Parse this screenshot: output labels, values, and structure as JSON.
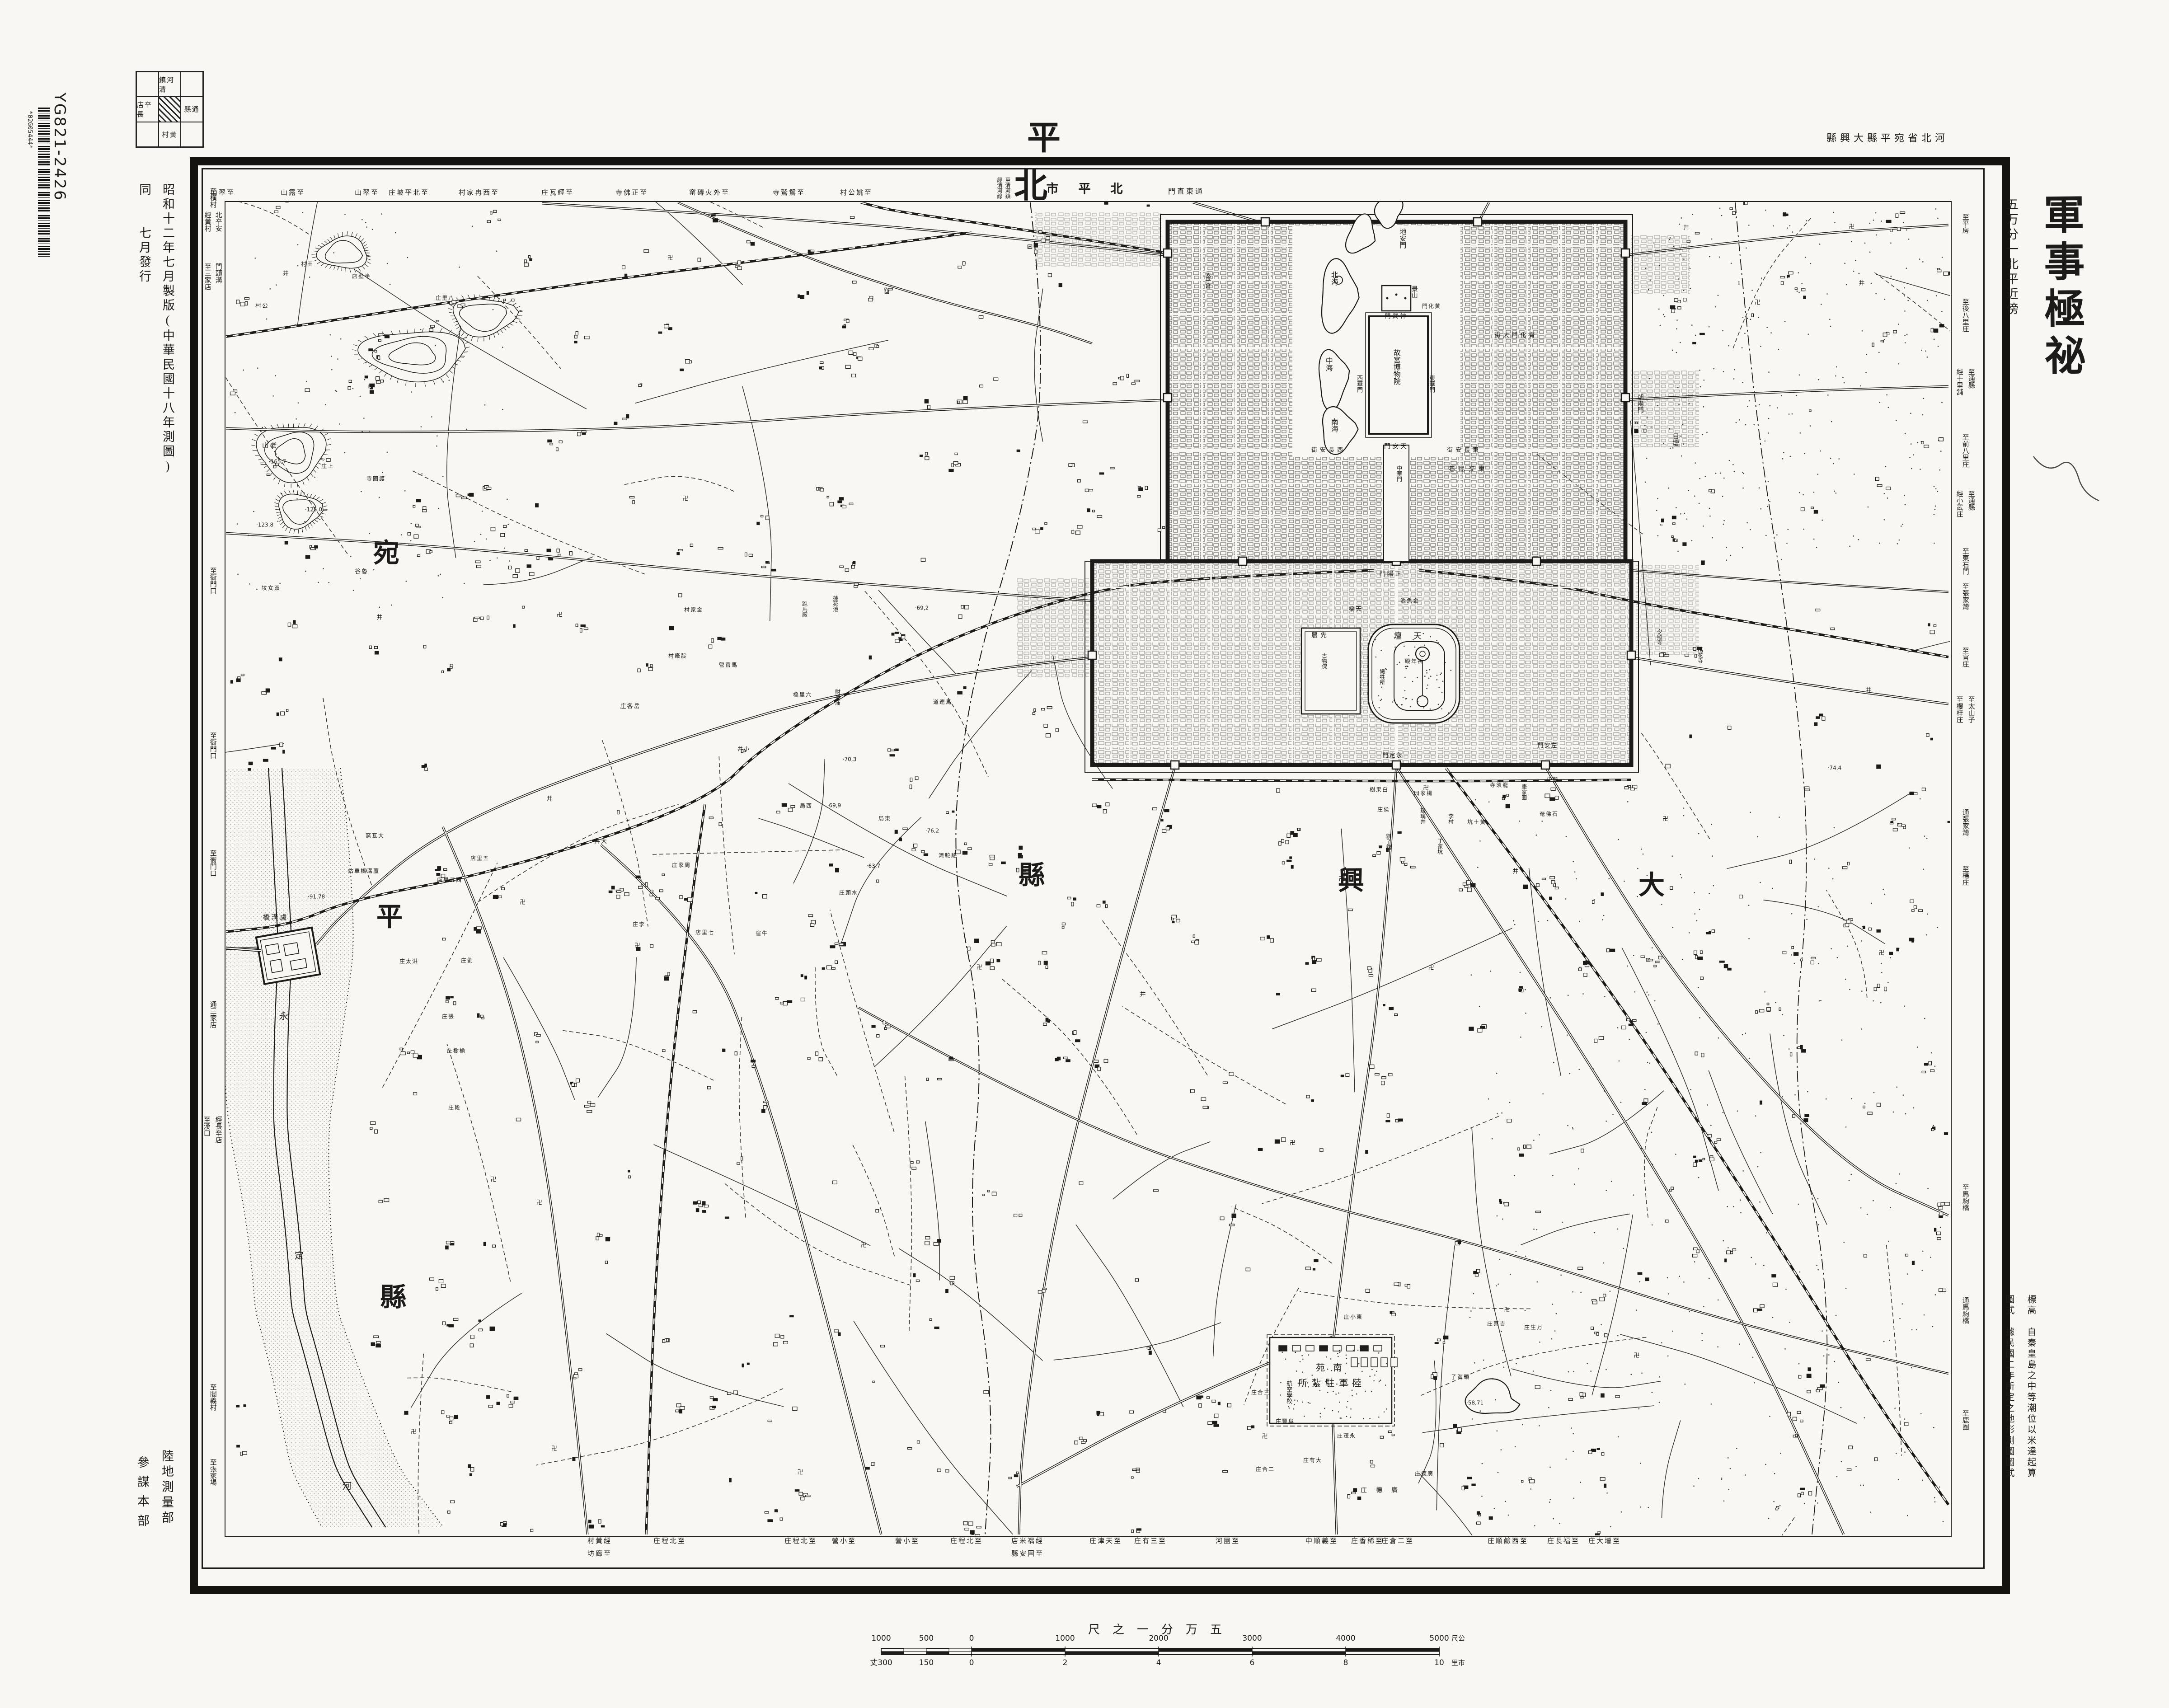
{
  "sheet": {
    "title": "平北",
    "region_note": "縣興大縣平宛省北河",
    "classification": "軍事極祕",
    "series": "五万分一北平近傍",
    "edition": "昭和十二年七月製版(中華民國十八年測圖)",
    "issue": "同　　七月發行",
    "surveyor": "陸地測量部",
    "staff": "參謀本部",
    "catalog_code": "YG821-2426",
    "barcode_text": "*02G05444*",
    "note_elevation": "標高　自秦皇島之中等潮位以米達起算",
    "note_style": "圖式　據民國二年所定之地形測圖圖式",
    "city_label": "市平北",
    "city_label_right": "門直東通",
    "city_label_left_1": "至清河鎮",
    "city_label_left_2": "經清河線"
  },
  "index_grid": {
    "top": "鎮河清",
    "left": "店辛長",
    "right": "縣通",
    "bottom": "村黄"
  },
  "scale_bar": {
    "caption": "尺之一分万五",
    "top_ticks": [
      "1000",
      "500",
      "0",
      "1000",
      "2000",
      "3000",
      "4000",
      "5000"
    ],
    "top_unit": "尺公",
    "bottom_ticks": [
      "丈300",
      "150",
      "0",
      "2",
      "4",
      "6",
      "8",
      "10"
    ],
    "bottom_unit": "里市"
  },
  "symbols": {
    "temple": "卍",
    "well": "井"
  },
  "colors": {
    "paper": "#f8f7f3",
    "ink": "#1d1b19"
  },
  "edge_labels": {
    "top": [
      {
        "t": "山翆至",
        "x": 493
      },
      {
        "t": "山露至",
        "x": 648
      },
      {
        "t": "山翆至",
        "x": 812
      },
      {
        "t": "庄坡平北至",
        "x": 905
      },
      {
        "t": "村家冉西至",
        "x": 1060
      },
      {
        "t": "庄瓦經至",
        "x": 1234
      },
      {
        "t": "寺佛正至",
        "x": 1398
      },
      {
        "t": "窰磚火外至",
        "x": 1570
      },
      {
        "t": "寺鷲鴛至",
        "x": 1746
      },
      {
        "t": "村公姚至",
        "x": 1895
      }
    ],
    "bottom": [
      {
        "t": "村黃經",
        "t2": "坊廊至",
        "x": 1327
      },
      {
        "t": "庄程北至",
        "x": 1482
      },
      {
        "t": "庄程北至",
        "x": 1772
      },
      {
        "t": "營小至",
        "x": 1868
      },
      {
        "t": "營小至",
        "x": 2008
      },
      {
        "t": "庄程北至",
        "x": 2139
      },
      {
        "t": "店米禑經",
        "t2": "縣安固至",
        "x": 2274
      },
      {
        "t": "庄津天至",
        "x": 2447
      },
      {
        "t": "庄有三至",
        "x": 2546
      },
      {
        "t": "河團至",
        "x": 2717
      },
      {
        "t": "中順義至",
        "x": 2925
      },
      {
        "t": "庄香稀至",
        "x": 3026
      },
      {
        "t": "庄倉二至",
        "x": 3093
      },
      {
        "t": "庄順鹼西至",
        "x": 3337
      },
      {
        "t": "庄長福至",
        "x": 3460
      },
      {
        "t": "庄大增至",
        "x": 3551
      }
    ],
    "left": [
      {
        "t": "至橫村",
        "y": 415
      },
      {
        "t": "北辛安",
        "y": 468,
        "dx": 12
      },
      {
        "t": "經黃村",
        "y": 468,
        "dx": -12
      },
      {
        "t": "門頭溝",
        "y": 582,
        "dx": 12
      },
      {
        "t": "至三家店",
        "y": 582,
        "dx": -12
      },
      {
        "t": "至衙門口",
        "y": 1255
      },
      {
        "t": "至衙門口",
        "y": 1620
      },
      {
        "t": "至衙門口",
        "y": 1880
      },
      {
        "t": "通三家店",
        "y": 2215
      },
      {
        "t": "經長辛店",
        "y": 2470,
        "dx": 12
      },
      {
        "t": "至漢口",
        "y": 2470,
        "dx": -14
      },
      {
        "t": "至閻義村",
        "y": 3062
      },
      {
        "t": "至張家場",
        "y": 3228
      }
    ],
    "right": [
      {
        "t": "至平房",
        "y": 472
      },
      {
        "t": "至後八里庄",
        "y": 660
      },
      {
        "t": "經十里舖",
        "y": 815,
        "dx": -13
      },
      {
        "t": "至通縣",
        "y": 815,
        "dx": 13
      },
      {
        "t": "至前八里庄",
        "y": 960
      },
      {
        "t": "經小武庄",
        "y": 1085,
        "dx": -13
      },
      {
        "t": "至通縣",
        "y": 1085,
        "dx": 13
      },
      {
        "t": "至東石門",
        "y": 1212
      },
      {
        "t": "至張家灣",
        "y": 1290
      },
      {
        "t": "至官庄",
        "y": 1432
      },
      {
        "t": "至樓梓庄",
        "y": 1540,
        "dx": -13
      },
      {
        "t": "至太山子",
        "y": 1540,
        "dx": 13
      },
      {
        "t": "通張家灣",
        "y": 1790
      },
      {
        "t": "至楊庄",
        "y": 1915
      },
      {
        "t": "至馬駒橋",
        "y": 2620
      },
      {
        "t": "通馬駒橋",
        "y": 2870
      },
      {
        "t": "至鹿圈",
        "y": 3120
      }
    ]
  },
  "map_labels": [
    {
      "t": "地安門",
      "m": "v",
      "x": 3102,
      "y": 505,
      "s": 15
    },
    {
      "t": "太平倉",
      "m": "v",
      "x": 2672,
      "y": 600,
      "s": 13
    },
    {
      "t": "北海",
      "m": "v",
      "x": 2950,
      "y": 600,
      "s": 16
    },
    {
      "t": "中海",
      "m": "v",
      "x": 2938,
      "y": 790,
      "s": 16
    },
    {
      "t": "南海",
      "m": "v",
      "x": 2950,
      "y": 925,
      "s": 16
    },
    {
      "t": "景山",
      "m": "v",
      "x": 3128,
      "y": 632,
      "s": 14
    },
    {
      "t": "門武神",
      "m": "h",
      "x": 3090,
      "y": 700,
      "s": 13,
      "ls": 4
    },
    {
      "t": "門化黄",
      "m": "h",
      "x": 3168,
      "y": 678,
      "s": 12,
      "ls": 2
    },
    {
      "t": "故宮博物院",
      "m": "v",
      "x": 3088,
      "y": 772,
      "s": 16
    },
    {
      "t": "西華門",
      "m": "v",
      "x": 3008,
      "y": 830,
      "s": 13
    },
    {
      "t": "東華門",
      "m": "v",
      "x": 3168,
      "y": 830,
      "s": 13
    },
    {
      "t": "門安天",
      "m": "h",
      "x": 3090,
      "y": 990,
      "s": 14,
      "ls": 4
    },
    {
      "t": "街安長西",
      "m": "h",
      "x": 2940,
      "y": 996,
      "s": 13,
      "ls": 6
    },
    {
      "t": "街安長東",
      "m": "h",
      "x": 3240,
      "y": 996,
      "s": 13,
      "ls": 6
    },
    {
      "t": "巷民交東",
      "m": "h",
      "x": 3250,
      "y": 1040,
      "s": 14,
      "ls": 8
    },
    {
      "t": "中華門",
      "m": "v",
      "x": 3096,
      "y": 1030,
      "s": 12
    },
    {
      "t": "門陽正",
      "m": "h",
      "x": 3078,
      "y": 1272,
      "s": 14,
      "ls": 3
    },
    {
      "t": "街大門化齊",
      "m": "h",
      "x": 3355,
      "y": 742,
      "s": 13,
      "ls": 6
    },
    {
      "t": "朝陽門",
      "m": "v",
      "x": 3628,
      "y": 872,
      "s": 14
    },
    {
      "t": "日壇",
      "m": "v",
      "x": 3706,
      "y": 958,
      "s": 15
    },
    {
      "t": "夕照寺",
      "m": "v",
      "x": 3672,
      "y": 1392,
      "s": 12
    },
    {
      "t": "括花寺",
      "m": "v",
      "x": 3762,
      "y": 1432,
      "s": 12
    },
    {
      "t": "橋天",
      "m": "h",
      "x": 3000,
      "y": 1348,
      "s": 13,
      "ls": 2
    },
    {
      "t": "池魚金",
      "m": "h",
      "x": 3120,
      "y": 1330,
      "s": 12,
      "ls": 2
    },
    {
      "t": "壇天",
      "m": "h",
      "x": 3128,
      "y": 1408,
      "s": 18,
      "ls": 26
    },
    {
      "t": "殿年祈",
      "m": "h",
      "x": 3130,
      "y": 1464,
      "s": 12,
      "ls": 2
    },
    {
      "t": "犧牲所",
      "m": "v",
      "x": 3058,
      "y": 1480,
      "s": 12
    },
    {
      "t": "農先",
      "m": "h",
      "x": 2922,
      "y": 1408,
      "s": 14,
      "ls": 6
    },
    {
      "t": "古物保",
      "m": "v",
      "x": 2930,
      "y": 1445,
      "s": 12
    },
    {
      "t": "門定永",
      "m": "h",
      "x": 3082,
      "y": 1672,
      "s": 13,
      "ls": 2
    },
    {
      "t": "門安左",
      "m": "h",
      "x": 3425,
      "y": 1650,
      "s": 13,
      "ls": 2
    },
    {
      "t": "樹果白",
      "m": "h",
      "x": 3052,
      "y": 1748,
      "s": 12,
      "ls": 2
    },
    {
      "t": "园家楊",
      "m": "h",
      "x": 3150,
      "y": 1756,
      "s": 12,
      "ls": 2
    },
    {
      "t": "寺須龍",
      "m": "h",
      "x": 3318,
      "y": 1738,
      "s": 12,
      "ls": 2
    },
    {
      "t": "康家园",
      "m": "v",
      "x": 3372,
      "y": 1735,
      "s": 12
    },
    {
      "t": "庄新",
      "m": "h",
      "x": 3436,
      "y": 1726,
      "s": 12,
      "ls": 2
    },
    {
      "t": "坑土黄",
      "m": "h",
      "x": 3268,
      "y": 1820,
      "s": 12,
      "ls": 2
    },
    {
      "t": "奄佛石",
      "m": "h",
      "x": 3428,
      "y": 1802,
      "s": 12,
      "ls": 2
    },
    {
      "t": "琉璃井",
      "m": "v",
      "x": 3148,
      "y": 1788,
      "s": 12
    },
    {
      "t": "李村",
      "m": "v",
      "x": 3210,
      "y": 1800,
      "s": 12
    },
    {
      "t": "丁家坑",
      "m": "v",
      "x": 3186,
      "y": 1855,
      "s": 12
    },
    {
      "t": "獅子舘",
      "m": "v",
      "x": 3072,
      "y": 1845,
      "s": 12
    },
    {
      "t": "庄侯",
      "m": "h",
      "x": 3062,
      "y": 1792,
      "s": 12,
      "ls": 2
    },
    {
      "t": "村公",
      "m": "h",
      "x": 580,
      "y": 677,
      "s": 13,
      "ls": 2
    },
    {
      "t": "村田",
      "m": "h",
      "x": 680,
      "y": 585,
      "s": 12,
      "ls": 2
    },
    {
      "t": "店壁半",
      "m": "h",
      "x": 800,
      "y": 612,
      "s": 12,
      "ls": 2
    },
    {
      "t": "庄里八",
      "m": "h",
      "x": 985,
      "y": 660,
      "s": 12,
      "ls": 2
    },
    {
      "t": "庄上",
      "m": "h",
      "x": 725,
      "y": 1032,
      "s": 12,
      "ls": 2
    },
    {
      "t": "山老",
      "m": "h",
      "x": 598,
      "y": 988,
      "s": 14,
      "ls": 4
    },
    {
      "t": "·165,7",
      "m": "h",
      "x": 614,
      "y": 1022,
      "s": 12,
      "num": 1
    },
    {
      "t": "寺國護",
      "m": "h",
      "x": 832,
      "y": 1060,
      "s": 12,
      "ls": 2
    },
    {
      "t": "·125,0",
      "m": "h",
      "x": 694,
      "y": 1128,
      "s": 12,
      "num": 1
    },
    {
      "t": "·123,8",
      "m": "h",
      "x": 586,
      "y": 1162,
      "s": 12,
      "num": 1
    },
    {
      "t": "谷魯",
      "m": "h",
      "x": 800,
      "y": 1265,
      "s": 13,
      "ls": 2
    },
    {
      "t": "坟女双",
      "m": "h",
      "x": 600,
      "y": 1302,
      "s": 12,
      "ls": 2
    },
    {
      "t": "宛",
      "m": "h",
      "x": 855,
      "y": 1225,
      "s": 58,
      "b": 1
    },
    {
      "t": "平",
      "m": "h",
      "x": 862,
      "y": 2030,
      "s": 58,
      "b": 1
    },
    {
      "t": "縣",
      "m": "h",
      "x": 870,
      "y": 2872,
      "s": 58,
      "b": 1
    },
    {
      "t": "縣",
      "m": "h",
      "x": 2283,
      "y": 1938,
      "s": 58,
      "b": 1
    },
    {
      "t": "興",
      "m": "h",
      "x": 2990,
      "y": 1950,
      "s": 58,
      "b": 1
    },
    {
      "t": "大",
      "m": "h",
      "x": 3655,
      "y": 1960,
      "s": 58,
      "b": 1
    },
    {
      "t": "永",
      "m": "h",
      "x": 628,
      "y": 2250,
      "s": 20
    },
    {
      "t": "定",
      "m": "h",
      "x": 662,
      "y": 2780,
      "s": 20
    },
    {
      "t": "河",
      "m": "h",
      "x": 768,
      "y": 3290,
      "s": 20
    },
    {
      "t": "橋溝盧",
      "m": "h",
      "x": 610,
      "y": 2032,
      "s": 15,
      "ls": 4
    },
    {
      "t": "·91,78",
      "m": "h",
      "x": 700,
      "y": 1985,
      "s": 12,
      "num": 1
    },
    {
      "t": "站車橋溝蘆",
      "m": "h",
      "x": 805,
      "y": 1928,
      "s": 12,
      "ls": 2
    },
    {
      "t": "窯瓦大",
      "m": "h",
      "x": 830,
      "y": 1850,
      "s": 12,
      "ls": 2
    },
    {
      "t": "店里五西",
      "m": "h",
      "x": 995,
      "y": 1948,
      "s": 12,
      "ls": 2
    },
    {
      "t": "店里五",
      "m": "h",
      "x": 1062,
      "y": 1900,
      "s": 12,
      "ls": 2
    },
    {
      "t": "庄太洪",
      "m": "h",
      "x": 905,
      "y": 2128,
      "s": 12,
      "ls": 2
    },
    {
      "t": "庄劉",
      "m": "h",
      "x": 1034,
      "y": 2126,
      "s": 12,
      "ls": 2
    },
    {
      "t": "庄張",
      "m": "h",
      "x": 992,
      "y": 2250,
      "s": 12,
      "ls": 2
    },
    {
      "t": "庄樹榆",
      "m": "h",
      "x": 1010,
      "y": 2326,
      "s": 12,
      "ls": 2
    },
    {
      "t": "庄段",
      "m": "h",
      "x": 1006,
      "y": 2452,
      "s": 12,
      "ls": 2
    },
    {
      "t": "庄各岳",
      "m": "h",
      "x": 1395,
      "y": 1563,
      "s": 13,
      "ls": 2
    },
    {
      "t": "村家金",
      "m": "h",
      "x": 1535,
      "y": 1350,
      "s": 12,
      "ls": 2
    },
    {
      "t": "村廠靛",
      "m": "h",
      "x": 1500,
      "y": 1452,
      "s": 12,
      "ls": 2
    },
    {
      "t": "營官馬",
      "m": "h",
      "x": 1612,
      "y": 1472,
      "s": 12,
      "ls": 2
    },
    {
      "t": "橋里六",
      "m": "h",
      "x": 1776,
      "y": 1538,
      "s": 12,
      "ls": 2
    },
    {
      "t": "跑馬廠",
      "m": "v",
      "x": 1780,
      "y": 1330,
      "s": 12
    },
    {
      "t": "蓮花池",
      "m": "v",
      "x": 1848,
      "y": 1318,
      "s": 12
    },
    {
      "t": "財神庙",
      "m": "v",
      "x": 1853,
      "y": 1525,
      "s": 12
    },
    {
      "t": "井小",
      "m": "h",
      "x": 1646,
      "y": 1658,
      "s": 12,
      "ls": 2
    },
    {
      "t": "井大",
      "m": "h",
      "x": 1330,
      "y": 1862,
      "s": 13,
      "ls": 2
    },
    {
      "t": "庄家周",
      "m": "h",
      "x": 1508,
      "y": 1915,
      "s": 12,
      "ls": 2
    },
    {
      "t": "店里七",
      "m": "h",
      "x": 1560,
      "y": 2064,
      "s": 12,
      "ls": 2
    },
    {
      "t": "庄李",
      "m": "h",
      "x": 1414,
      "y": 2046,
      "s": 12,
      "ls": 2
    },
    {
      "t": "窪牛",
      "m": "h",
      "x": 1686,
      "y": 2066,
      "s": 12,
      "ls": 2
    },
    {
      "t": "局西",
      "m": "h",
      "x": 1784,
      "y": 1784,
      "s": 12,
      "ls": 2
    },
    {
      "t": "局東",
      "m": "h",
      "x": 1958,
      "y": 1812,
      "s": 12,
      "ls": 2
    },
    {
      "t": "庄頭水",
      "m": "h",
      "x": 1878,
      "y": 1976,
      "s": 12,
      "ls": 2
    },
    {
      "t": "道連馬",
      "m": "h",
      "x": 2086,
      "y": 1554,
      "s": 12,
      "ls": 2
    },
    {
      "t": "湾駝駱",
      "m": "h",
      "x": 2098,
      "y": 1894,
      "s": 12,
      "ls": 2
    },
    {
      "t": "·69,2",
      "m": "h",
      "x": 2040,
      "y": 1346,
      "s": 12,
      "num": 1
    },
    {
      "t": "·70,3",
      "m": "h",
      "x": 1880,
      "y": 1681,
      "s": 12,
      "num": 1
    },
    {
      "t": "·69,9",
      "m": "h",
      "x": 1846,
      "y": 1783,
      "s": 12,
      "num": 1
    },
    {
      "t": "·63,7",
      "m": "h",
      "x": 1933,
      "y": 1917,
      "s": 12,
      "num": 1
    },
    {
      "t": "·76,2",
      "m": "h",
      "x": 2063,
      "y": 1839,
      "s": 12,
      "num": 1
    },
    {
      "t": "·74,4",
      "m": "h",
      "x": 4060,
      "y": 1700,
      "s": 12,
      "num": 1
    },
    {
      "t": "苑南",
      "m": "h",
      "x": 2950,
      "y": 3028,
      "s": 20,
      "ls": 18
    },
    {
      "t": "所紮駐軍陸",
      "m": "h",
      "x": 2948,
      "y": 3062,
      "s": 20,
      "ls": 10
    },
    {
      "t": "航空學校",
      "m": "v",
      "x": 2852,
      "y": 3055,
      "s": 13
    },
    {
      "t": "庄茂永",
      "m": "h",
      "x": 2980,
      "y": 3178,
      "s": 12,
      "ls": 2
    },
    {
      "t": "庄有大",
      "m": "h",
      "x": 2905,
      "y": 3232,
      "s": 12,
      "ls": 2
    },
    {
      "t": "庄德廣",
      "m": "h",
      "x": 3062,
      "y": 3300,
      "s": 14,
      "ls": 20
    },
    {
      "t": "庄德廣",
      "m": "h",
      "x": 3152,
      "y": 3262,
      "s": 12,
      "ls": 2
    },
    {
      "t": "子海頭",
      "m": "h",
      "x": 3232,
      "y": 3048,
      "s": 12,
      "ls": 2
    },
    {
      "t": "·58,71",
      "m": "h",
      "x": 3264,
      "y": 3105,
      "s": 12,
      "num": 1
    },
    {
      "t": "庄小東",
      "m": "h",
      "x": 2995,
      "y": 2915,
      "s": 12,
      "ls": 2
    },
    {
      "t": "庄喜吉",
      "m": "h",
      "x": 3312,
      "y": 2930,
      "s": 12,
      "ls": 2
    },
    {
      "t": "庄生万",
      "m": "h",
      "x": 3394,
      "y": 2938,
      "s": 12,
      "ls": 2
    },
    {
      "t": "庄合三",
      "m": "h",
      "x": 2790,
      "y": 3082,
      "s": 12,
      "ls": 2
    },
    {
      "t": "庄豐阜",
      "m": "h",
      "x": 2844,
      "y": 3146,
      "s": 12,
      "ls": 2
    },
    {
      "t": "庄合二",
      "m": "h",
      "x": 2800,
      "y": 3252,
      "s": 12,
      "ls": 2
    }
  ]
}
